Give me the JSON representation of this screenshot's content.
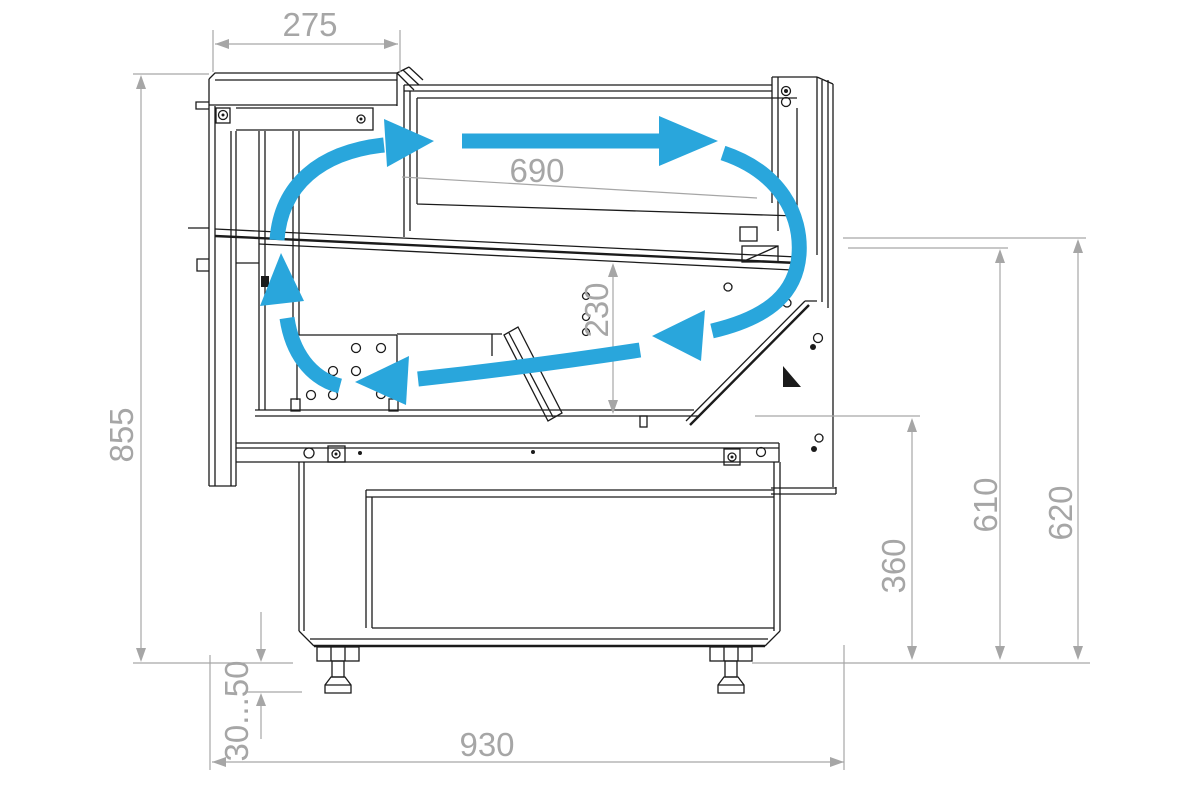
{
  "drawing": {
    "type": "technical-drawing",
    "subject": "Refrigerated serve-over display counter — side cross-section with air circulation",
    "units": "mm",
    "colors": {
      "outline": "#1b1b1b",
      "dimension": "#a6a6a6",
      "airflow": "#29a6dc",
      "background": "#ffffff"
    },
    "dimensions": {
      "canopy_depth": "275",
      "display_opening_width": "690",
      "well_depth": "230",
      "overall_height": "855",
      "foot_adjustment": "30...50",
      "overall_depth": "930",
      "well_floor_height": "360",
      "middle_level_height": "610",
      "top_edge_height": "620"
    },
    "airflow": {
      "color": "#29a6dc",
      "arrows": [
        "duct-up-arrow",
        "top-left-curve-arrow",
        "top-horizontal-arrow",
        "front-down-curve-arrow",
        "well-return-arrow"
      ]
    }
  }
}
